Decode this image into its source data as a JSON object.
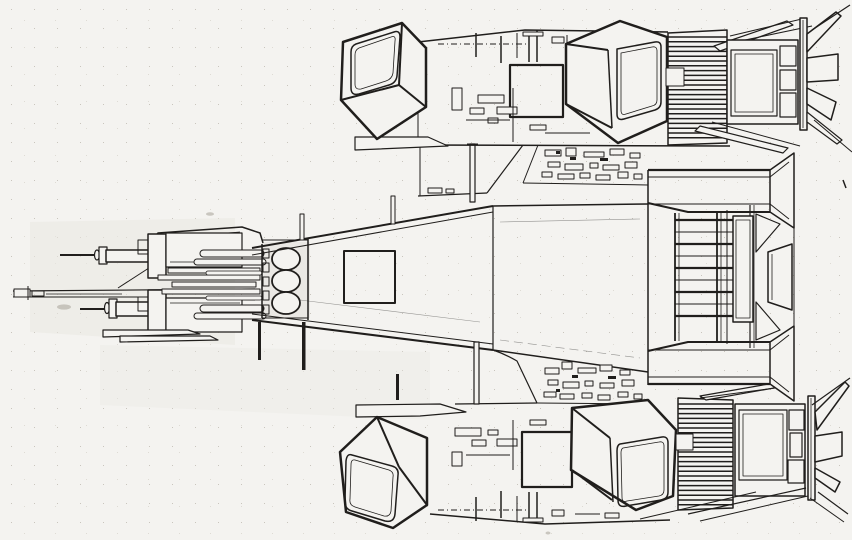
{
  "figure": {
    "kind": "technical-line-drawing",
    "subject": "spacecraft top-view schematic, hand-drawn scan, nose pointing left",
    "palette": {
      "paper": "#f4f3f0",
      "ink": "#201e1c",
      "wash": "#e9e7e2",
      "speck": "#c9c5bd"
    },
    "components": [
      "nose-boom",
      "upper-cannon",
      "lower-cannon",
      "forward-hull-block",
      "engine-cluster-trio",
      "forward-taper",
      "center-hull",
      "upper-deck-greebles",
      "lower-deck-greebles",
      "upper-outrigger-band",
      "lower-outrigger-band",
      "cargo-cube-upper-left",
      "cargo-cube-upper-right",
      "cargo-cube-lower-left",
      "cargo-cube-lower-right",
      "radiator-upper",
      "radiator-lower",
      "engine-pod-upper",
      "engine-pod-lower",
      "stern-pylon-upper",
      "stern-pylon-lower",
      "stern-ladder"
    ]
  }
}
